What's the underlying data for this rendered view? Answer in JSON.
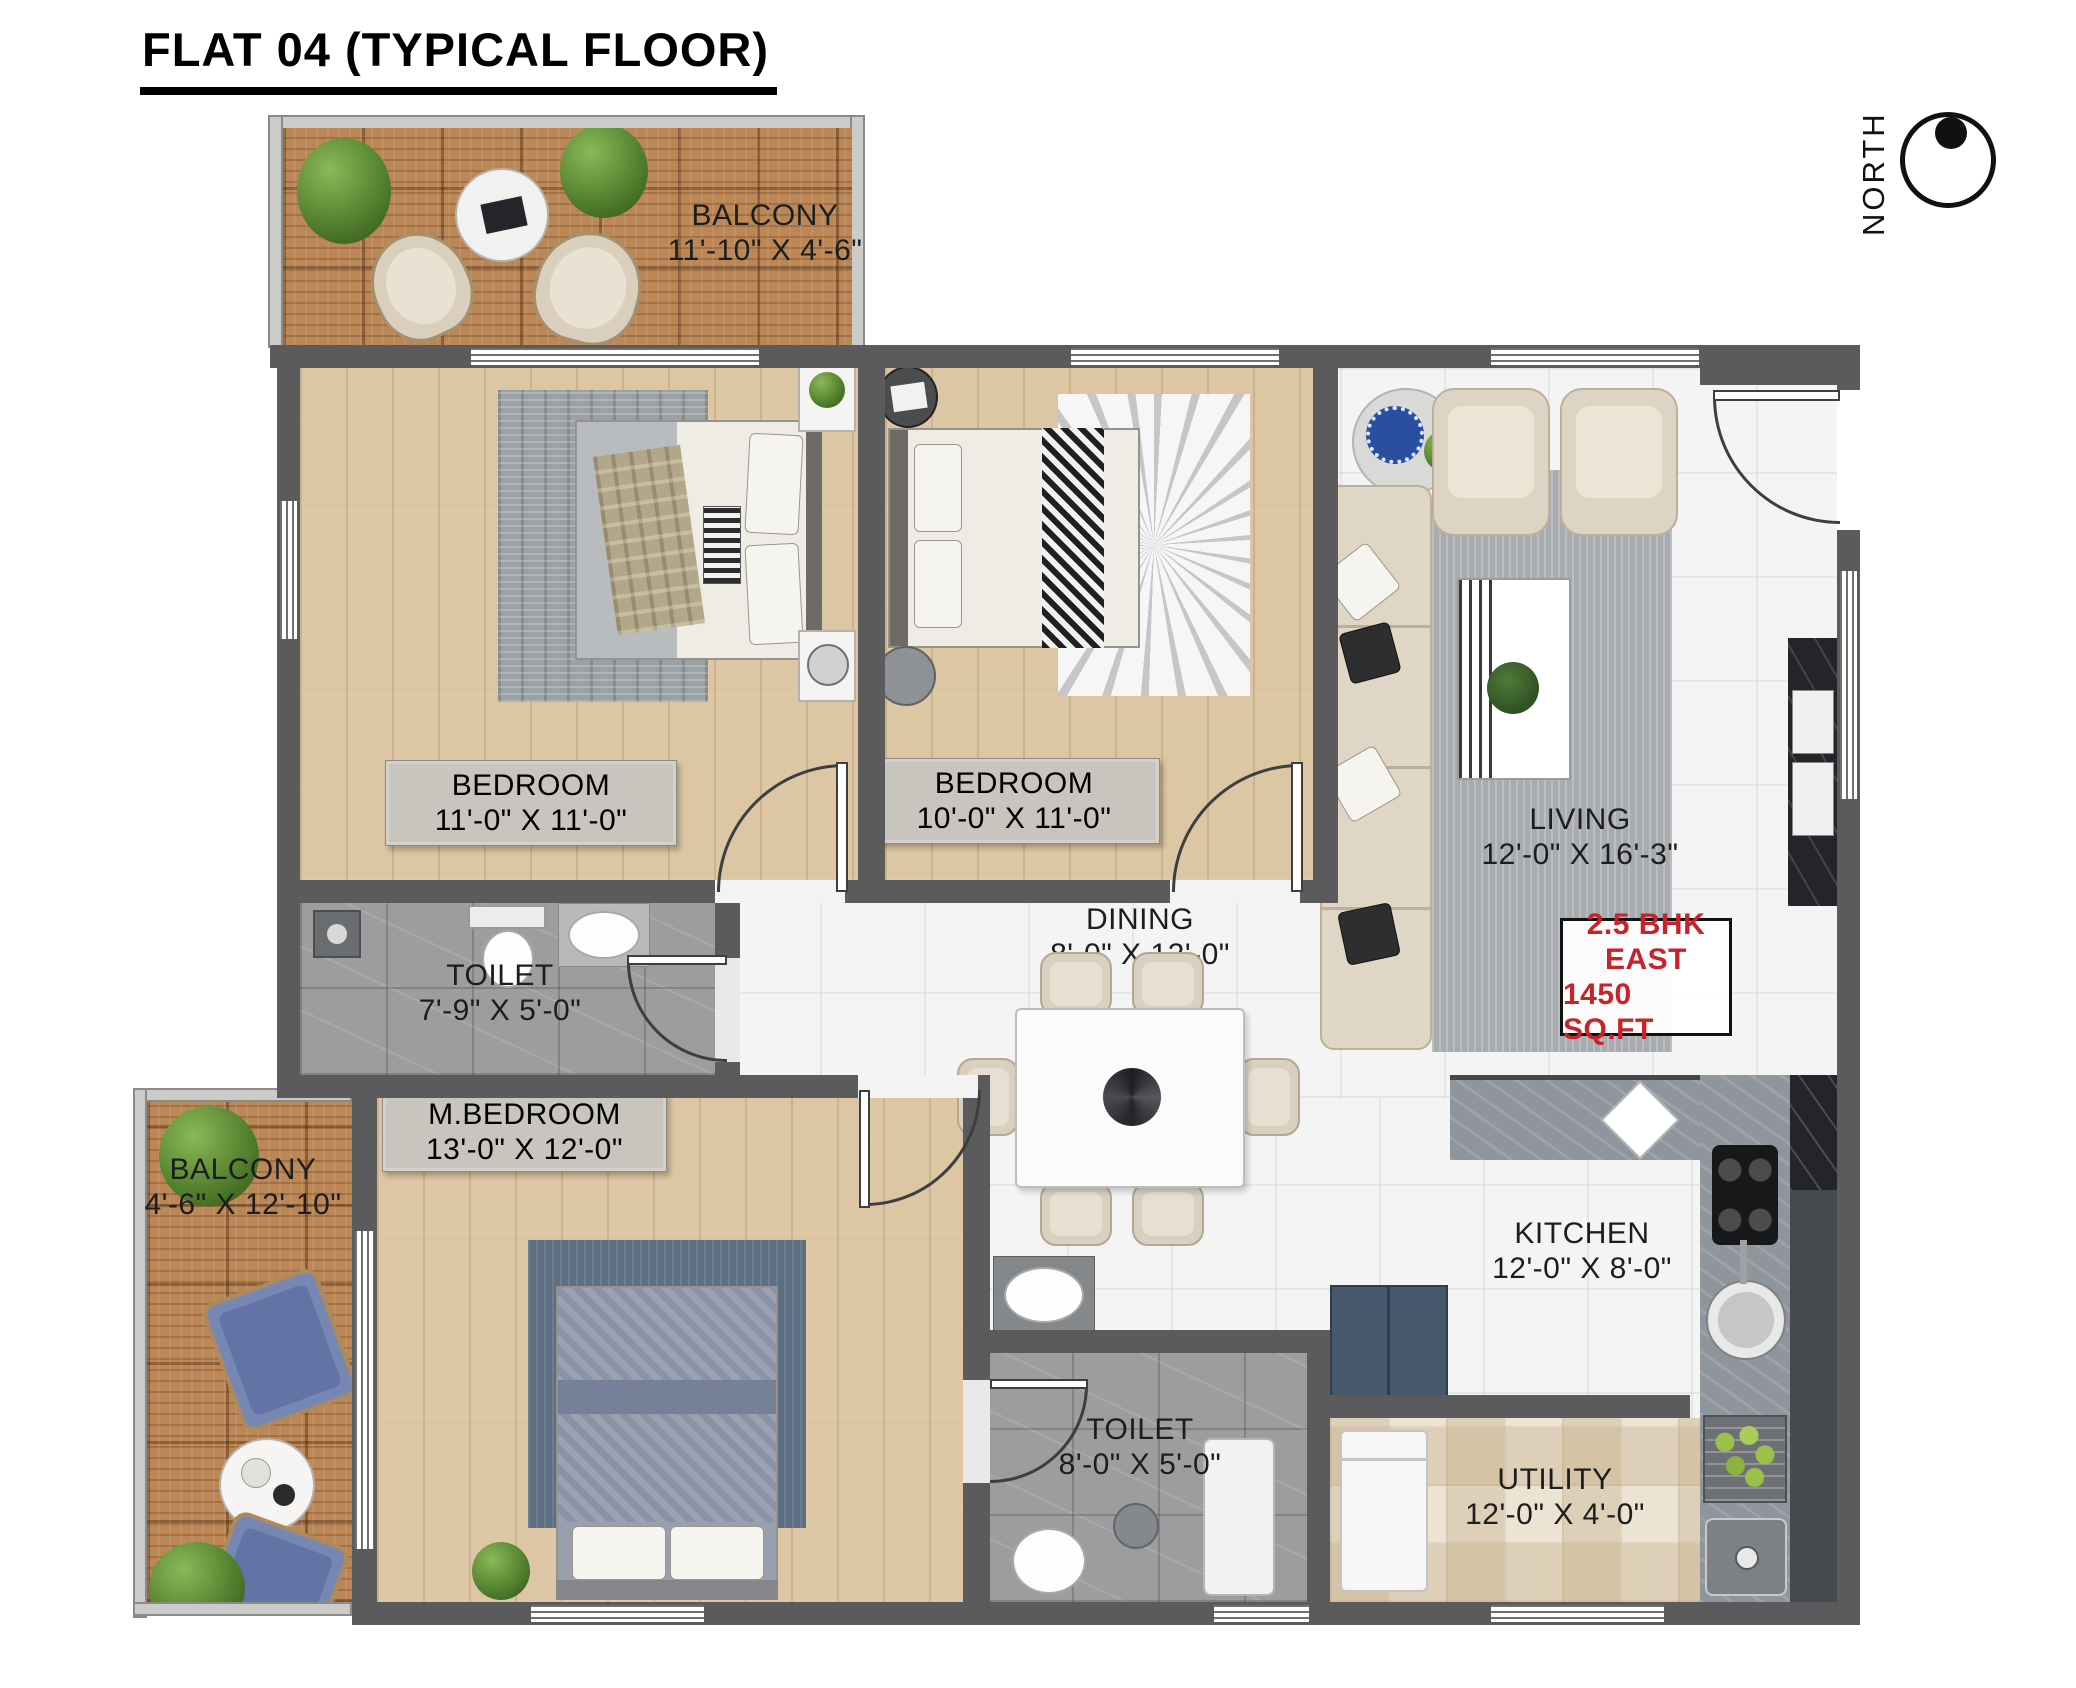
{
  "title": "FLAT 04 (TYPICAL FLOOR)",
  "compass": {
    "label": "NORTH"
  },
  "info_box": {
    "lines": [
      "2.5 BHK",
      "EAST",
      "1450 SQ.FT"
    ]
  },
  "rooms": {
    "balcony_top": {
      "name": "BALCONY",
      "dims": "11'-10\" X 4'-6\""
    },
    "bedroom_1": {
      "name": "BEDROOM",
      "dims": "11'-0\" X 11'-0\""
    },
    "bedroom_2": {
      "name": "BEDROOM",
      "dims": "10'-0\" X 11'-0\""
    },
    "living": {
      "name": "LIVING",
      "dims": "12'-0\" X 16'-3\""
    },
    "toilet_1": {
      "name": "TOILET",
      "dims": "7'-9\" X 5'-0\""
    },
    "dining": {
      "name": "DINING",
      "dims": "8'-0\" X 12'-0\""
    },
    "master_bedroom": {
      "name": "M.BEDROOM",
      "dims": "13'-0\" X 12'-0\""
    },
    "balcony_left": {
      "name": "BALCONY",
      "dims": "4'-6\" X 12'-10\""
    },
    "kitchen": {
      "name": "KITCHEN",
      "dims": "12'-0\" X 8'-0\""
    },
    "toilet_2": {
      "name": "TOILET",
      "dims": "8'-0\" X 5'-0\""
    },
    "utility": {
      "name": "UTILITY",
      "dims": "12'-0\" X 4'-0\""
    }
  },
  "colors": {
    "wall": "#5b5b5d",
    "wood": "#dcc6a3",
    "deck": "#bb8756",
    "marble": "#f4f4f5",
    "graytile": "#9d9da0",
    "creamtile": "#ece3d2",
    "granite": "#8e959c",
    "accent": "#c8232a",
    "label": "#1d1d1d"
  }
}
